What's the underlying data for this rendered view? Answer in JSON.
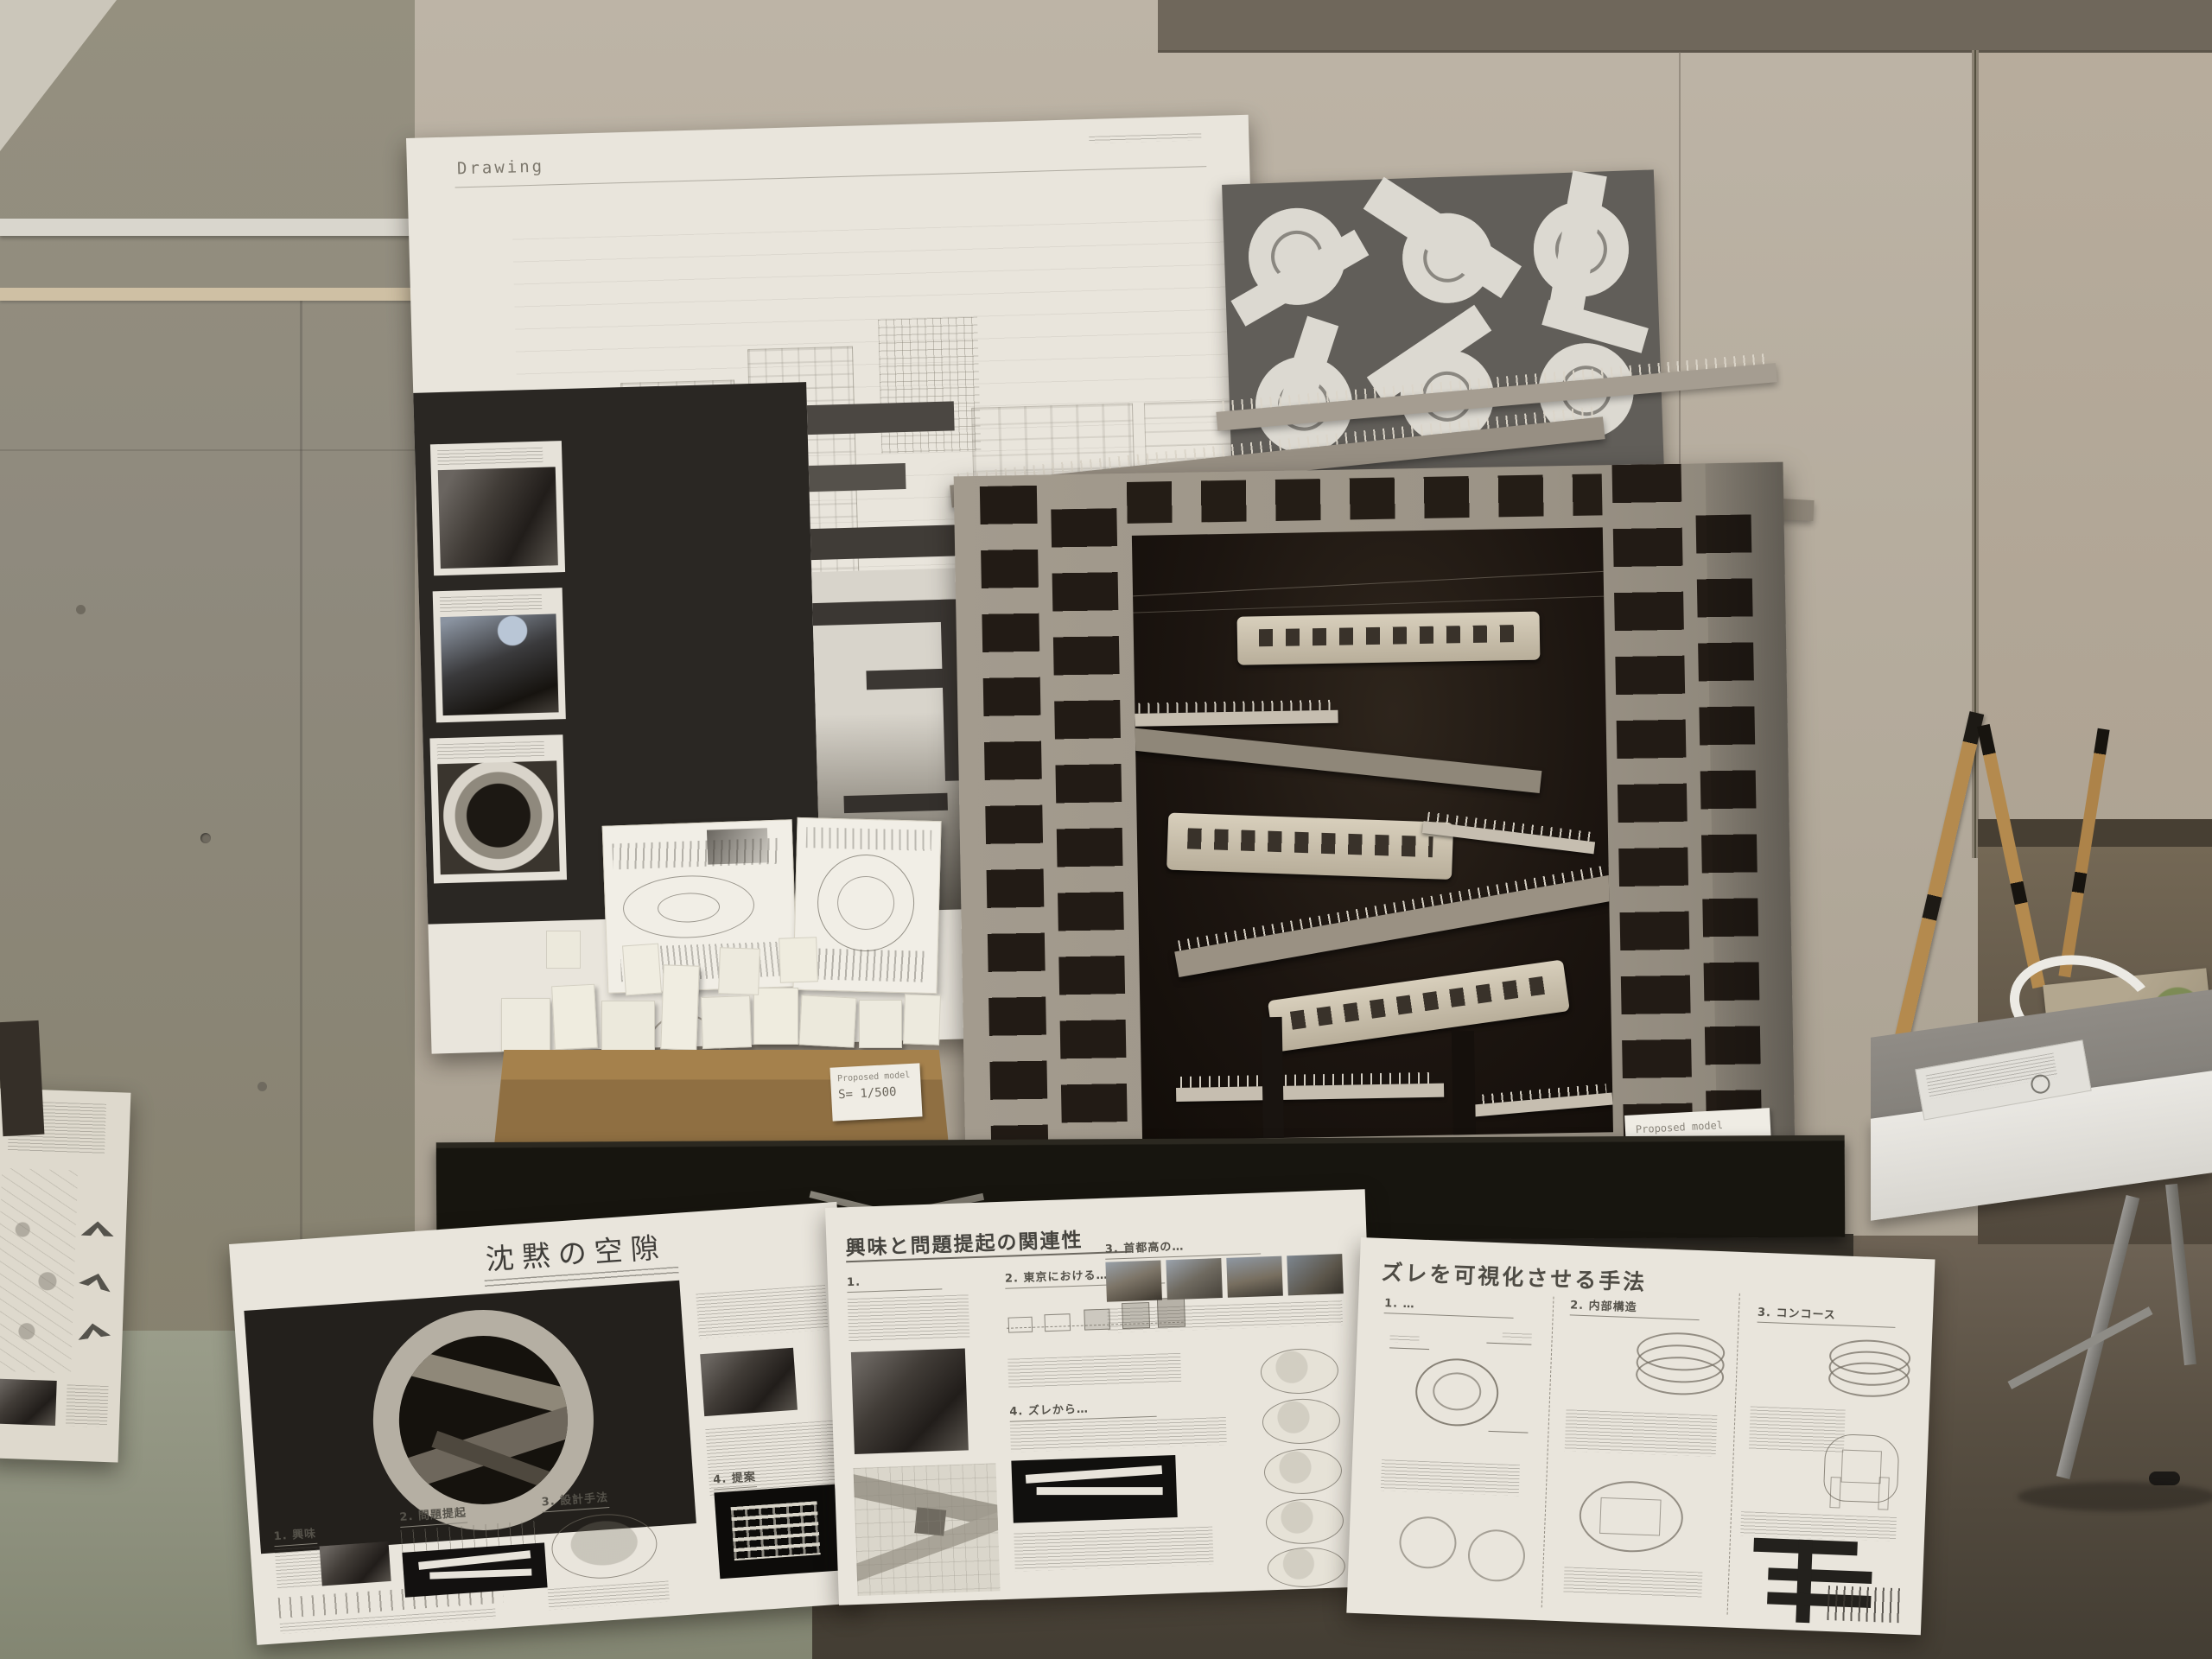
{
  "scene": {
    "description": "Photograph of an architecture studio exhibition: presentation boards, a large sectional cardboard model with model trains, a small white site model, and leaning poster boards",
    "colors": {
      "wall_concrete": "#8f8a7e",
      "wall_beige": "#b6ad9f",
      "wall_dark_band": "#6f675b",
      "floor_left": "#979a87",
      "floor_right": "#6e6355",
      "table": "#17150f",
      "model_grey": "#a09889",
      "model_interior": "#1d1712",
      "cardboard_base": "#9b7947",
      "board_white": "#e9e5dc",
      "dark_panel": "#2a2723",
      "plans_board": "#615e59"
    }
  },
  "drawing_board": {
    "label": "Drawing"
  },
  "plans_board": {
    "rows": 2,
    "cols": 3
  },
  "large_model": {
    "label_title": "Proposed model",
    "label_scale": "S= 1/100",
    "train_count": 3
  },
  "small_model": {
    "label_title": "Proposed model",
    "label_scale": "S= 1/500"
  },
  "board_silence": {
    "title": "沈黙の空隙",
    "sections": [
      {
        "label": "1. 興味"
      },
      {
        "label": "2. 問題提起"
      },
      {
        "label": "3. 設計手法"
      },
      {
        "label": "4. 提案"
      }
    ]
  },
  "board_interest": {
    "title": "興味と問題提起の関連性",
    "sections": [
      {
        "label": "1."
      },
      {
        "label": "2. 東京における…"
      },
      {
        "label": "3. 首都高の…"
      },
      {
        "label": "4. ズレから…"
      }
    ]
  },
  "board_method": {
    "title": "ズレを可視化させる手法",
    "sections": [
      {
        "label": "1. …"
      },
      {
        "label": "2. 内部構造"
      },
      {
        "label": "3. コンコース"
      }
    ]
  }
}
